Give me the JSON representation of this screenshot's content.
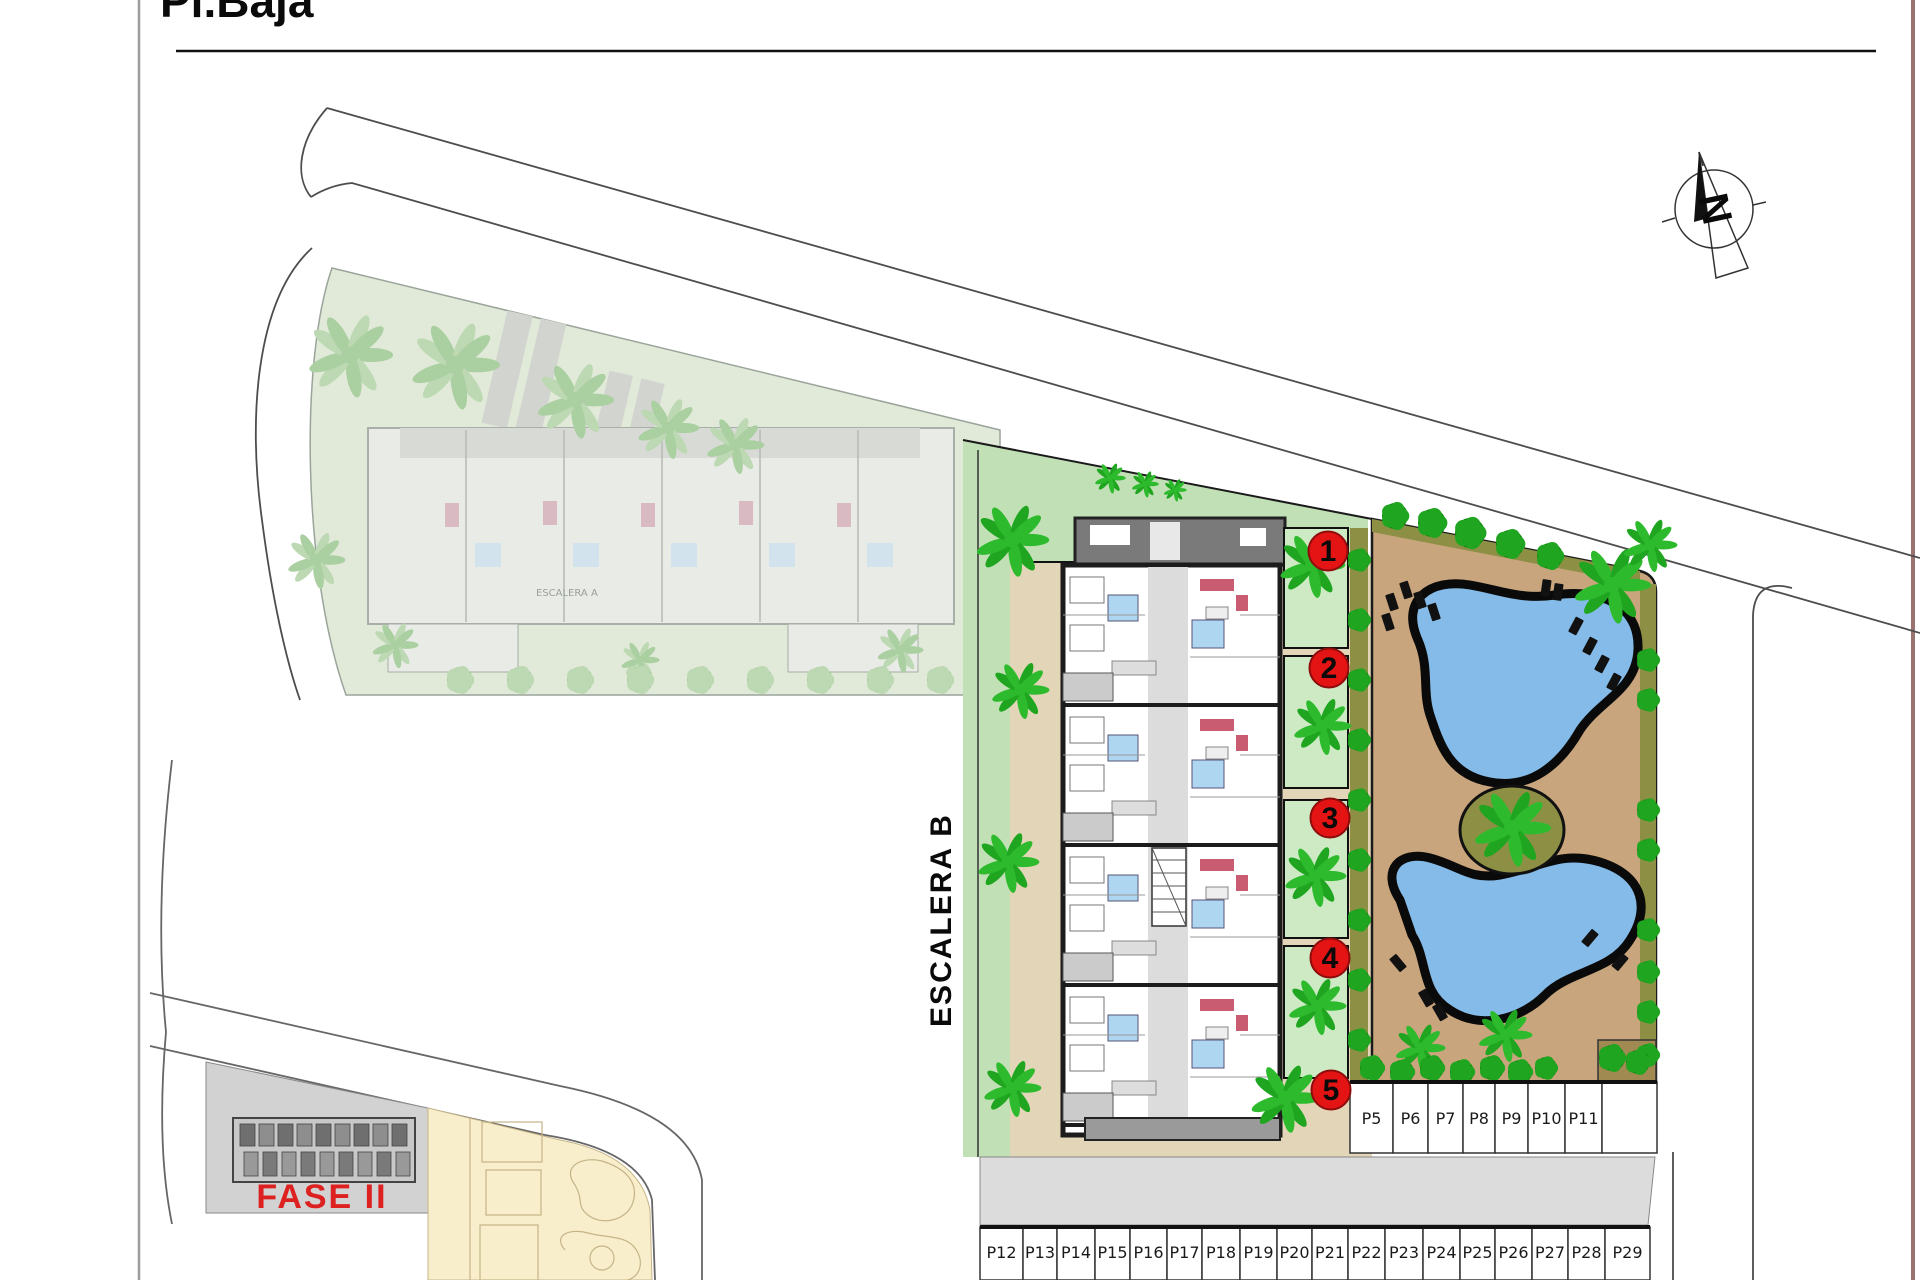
{
  "page": {
    "title": "Pl.Baja"
  },
  "compass": {
    "label": "N"
  },
  "site": {
    "stair_label": "ESCALERA B",
    "unit_markers": [
      "1",
      "2",
      "3",
      "4",
      "5"
    ]
  },
  "faded_block": {
    "stair_label": "ESCALERA A"
  },
  "phase2": {
    "label": "FASE II"
  },
  "parking": {
    "upper_row": [
      "P5",
      "P6",
      "P7",
      "P8",
      "P9",
      "P10",
      "P11"
    ],
    "lower_row": [
      "P12",
      "P13",
      "P14",
      "P15",
      "P16",
      "P17",
      "P18",
      "P19",
      "P20",
      "P21",
      "P22",
      "P23",
      "P24",
      "P25",
      "P26",
      "P27",
      "P28",
      "P29"
    ]
  },
  "colors": {
    "marker_red": "#e41414",
    "marker_edge": "#8e0c0c",
    "phase2_red": "#dd2020",
    "pool_blue": "#85bbe8",
    "deck_tan": "#c9a57d",
    "courtyard_tan": "#e3d6b8",
    "lawn_green": "#c2e0b6",
    "garden_green": "#cdeac4",
    "hedge_olive": "#8d9044",
    "tree_green": "#1fa51f",
    "road_gray": "#dcdcdc",
    "parcel_beige": "#f8eecb"
  }
}
